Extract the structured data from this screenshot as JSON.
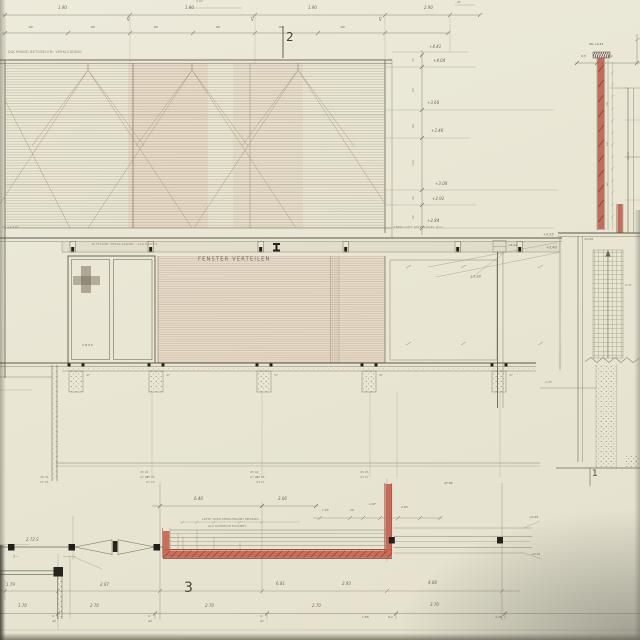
{
  "sheet": {
    "detail_markers": {
      "elevation": "2",
      "plan": "3",
      "section": "1"
    },
    "annotations": {
      "roof_edge": "DACHRAND BETONELEM. VERKLEIDUNG",
      "glazing_rail": "KITTLOSE VERGLASUNG · ALU PROFIL",
      "skylight": "OBERLICHT KIPPFLÜGEL ALU",
      "window_area": "FENSTER VERTEILEN",
      "window_mark": "2 Ø 9 6",
      "wall_base": "OK +2.175",
      "cap": "OK +4.41",
      "glass": "GLAS",
      "sill_note1": "LATTE 30/50 VERSCHRAUBT MESSING",
      "sill_note2": "ALU SCHWELLE ELOXIERT",
      "door_width": "2.72 S",
      "corner_ref": "2~",
      "footing_leader": "-1.05",
      "base_level": "±0.00",
      "masonry": "2.47"
    },
    "levels": {
      "stack": [
        "+4.41",
        "+4.04",
        "+3.60",
        "+3.46",
        "+3.08",
        "+2.92",
        "+2.84"
      ],
      "chain": [
        "37",
        "97",
        "66",
        "152",
        "46",
        "22"
      ],
      "beam": [
        "+3.52",
        "+3.46",
        "+3.38",
        "+3.44"
      ]
    },
    "dims": {
      "top_note": "2.02",
      "top_note2": ".45",
      "top_row1": [
        "1.90",
        "45",
        "1.90",
        "45",
        "1.90",
        "45",
        "2.90"
      ],
      "top_row2": [
        ".90",
        ".90",
        ".90",
        ".90",
        ".90",
        ".90"
      ],
      "right_top": [
        "9.5",
        "12"
      ],
      "wall_chain": [
        "36",
        "52",
        "47"
      ],
      "post_marks": [
        "47",
        "47",
        "47",
        "47",
        "47"
      ],
      "post_stacks": [
        {
          "a": "45 45",
          "b": "27 24"
        },
        {
          "a": "45 44",
          "b": "27 24"
        },
        {
          "a": "45 45",
          "b": "24 27"
        }
      ],
      "plan_stacks": [
        {
          "a": "45 44",
          "b": "27 24"
        },
        {
          "a": "45 45",
          "b": "27 24"
        },
        {
          "a": "44 45",
          "b": "24 27"
        }
      ],
      "plan_wide": "47.88",
      "plan_top": [
        "6.40",
        "2.06",
        "1.03",
        ".40",
        "1.67",
        "2.93"
      ],
      "plan_leaders": [
        "+0.45",
        "+0.12"
      ],
      "plan_row1": [
        "1.79",
        "2.07",
        "6.81",
        "2.93",
        "4.88"
      ],
      "plan_row2": [
        "1.70",
        "2.70",
        "2.70",
        "2.70",
        "2.70"
      ],
      "axis_stacks": [
        {
          "a": "4",
          "b": "43"
        },
        {
          "a": "4",
          "b": "44"
        },
        {
          "a": "4",
          "b": "47"
        }
      ],
      "axis_right": [
        "1.80",
        "8.2",
        "4.28"
      ]
    }
  }
}
